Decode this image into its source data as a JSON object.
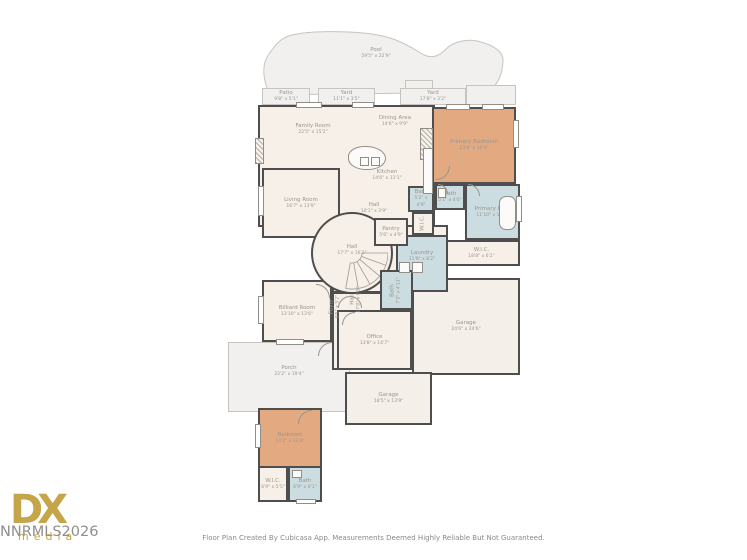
{
  "footer": {
    "caption": "Floor Plan Created By Cubicasa App. Measurements Deemed Highly Reliable But Not Guaranteed."
  },
  "watermark": {
    "logo_main": "DX",
    "logo_sub": "media",
    "overlay_text": "NNRMLS2026",
    "gold_color": "#c5a44a",
    "gray_color": "#8e8e8e"
  },
  "colors": {
    "wall": "#4e4e4e",
    "room_fill": "#f6f0e9",
    "bedroom_fill": "#e3aa81",
    "bath_fill": "#cbdde0",
    "outdoor_fill": "#f1f0ee",
    "outdoor_border": "#c7c4bf",
    "label_text": "#9b958e"
  },
  "rooms": {
    "pool": {
      "name": "Pool",
      "dims": "59'5\" x 22'9\""
    },
    "patio": {
      "name": "Patio",
      "dims": "9'8\" x 5'1\""
    },
    "yard1": {
      "name": "Yard",
      "dims": "11'1\" x 3'5\""
    },
    "yard2": {
      "name": "Yard",
      "dims": "17'8\" x 3'2\""
    },
    "family": {
      "name": "Family Room",
      "dims": "22'5\" x 15'2\""
    },
    "dining": {
      "name": "Dining Area",
      "dims": "14'6\" x 9'9\""
    },
    "kitchen": {
      "name": "Kitchen",
      "dims": "14'6\" x 11'1\""
    },
    "primary_bedroom": {
      "name": "Primary Bedroom",
      "dims": "13'8\" x 16'4\""
    },
    "bath_upper": {
      "name": "Bath",
      "dims": "5'1\" x 4'6\""
    },
    "primary_bath": {
      "name": "Primary Bath",
      "dims": "11'10\" x 13'8\""
    },
    "wic_primary": {
      "name": "W.I.C.",
      "dims": "18'8\" x 6'2\""
    },
    "living": {
      "name": "Living Room",
      "dims": "16'7\" x 13'9\""
    },
    "hall_round": {
      "name": "Hall",
      "dims": "17'7\" x 16'2\""
    },
    "hall_small": {
      "name": "Hall",
      "dims": "10'1\" x 3'9\""
    },
    "bath_mid": {
      "name": "Bath",
      "dims": "5'2\" x 4'9\""
    },
    "pantry": {
      "name": "Pantry",
      "dims": "5'6\" x 4'9\""
    },
    "wic_mid": {
      "name": "W.I.C."
    },
    "laundry": {
      "name": "Laundry",
      "dims": "11'9\" x 8'2\""
    },
    "billiard": {
      "name": "Billiard Room",
      "dims": "13'10\" x 13'6\""
    },
    "foyer": {
      "name": "Foyer",
      "dims": "9'5\" x 5'2\""
    },
    "hall_lower": {
      "name": "Hall",
      "dims": "17'8\" x 6'5\""
    },
    "bath_lower_mid": {
      "name": "Bath",
      "dims": "7'5\" x 4'11\""
    },
    "office": {
      "name": "Office",
      "dims": "13'8\" x 14'7\""
    },
    "garage": {
      "name": "Garage",
      "dims": "24'6\" x 24'6\""
    },
    "porch": {
      "name": "Porch",
      "dims": "22'2\" x 19'4\""
    },
    "garage2": {
      "name": "Garage",
      "dims": "18'5\" x 13'9\""
    },
    "bedroom2": {
      "name": "Bedroom",
      "dims": "14'2\" x 13'8\""
    },
    "wic_lower": {
      "name": "W.I.C.",
      "dims": "6'9\" x 5'5\""
    },
    "bath_lower": {
      "name": "Bath",
      "dims": "6'9\" x 6'1\""
    }
  }
}
